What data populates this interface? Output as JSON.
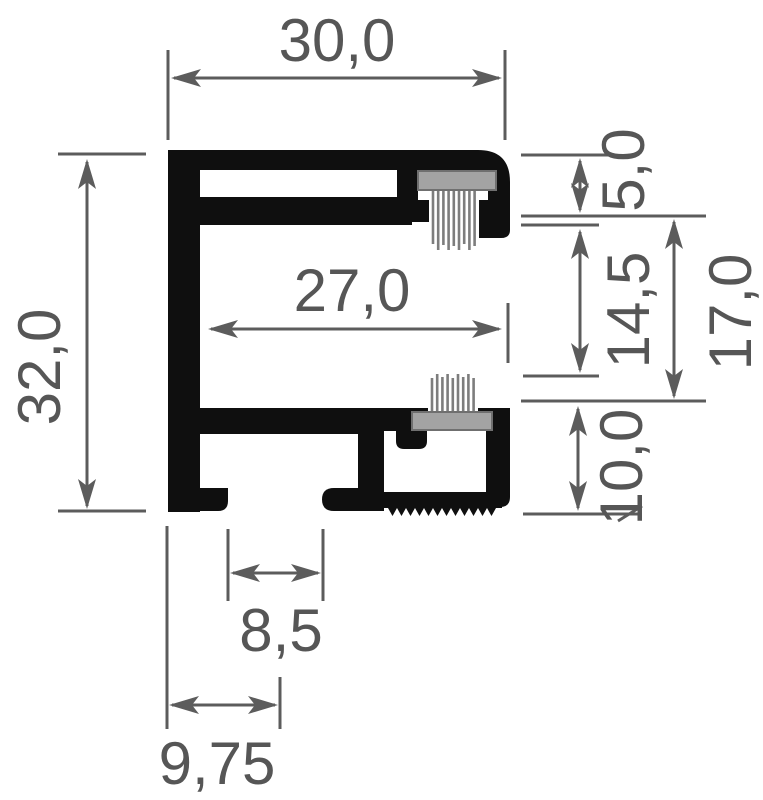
{
  "drawing": {
    "title": "Aluminium profile cross-section with brush seals",
    "background_color": "#ffffff",
    "profile_color": "#0f0f0f",
    "dimension_color": "#5c5c5c",
    "brush_holder_color": "#a3a3a3",
    "brush_bristle_color": "#7d7d7d"
  },
  "dimensions": {
    "width_total": {
      "label": "30,0",
      "value": 30.0,
      "orientation": "horizontal",
      "location": "top overall width"
    },
    "height_total": {
      "label": "32,0",
      "value": 32.0,
      "orientation": "vertical",
      "location": "left overall height"
    },
    "width_inner": {
      "label": "27,0",
      "value": 27.0,
      "orientation": "horizontal",
      "location": "inner channel width"
    },
    "top_flange": {
      "label": "5,0",
      "value": 5.0,
      "orientation": "vertical",
      "location": "right top flange height"
    },
    "opening": {
      "label": "14,5",
      "value": 14.5,
      "orientation": "vertical",
      "location": "right brush opening height"
    },
    "side_depth": {
      "label": "17,0",
      "value": 17.0,
      "orientation": "vertical",
      "location": "right groove overall height"
    },
    "bottom_section": {
      "label": "10,0",
      "value": 10.0,
      "orientation": "vertical",
      "location": "right bottom section height"
    },
    "foot_gap": {
      "label": "8,5",
      "value": 8.5,
      "orientation": "horizontal",
      "location": "bottom foot gap width"
    },
    "foot_offset": {
      "label": "9,75",
      "value": 9.75,
      "orientation": "horizontal",
      "location": "bottom left foot offset"
    }
  }
}
